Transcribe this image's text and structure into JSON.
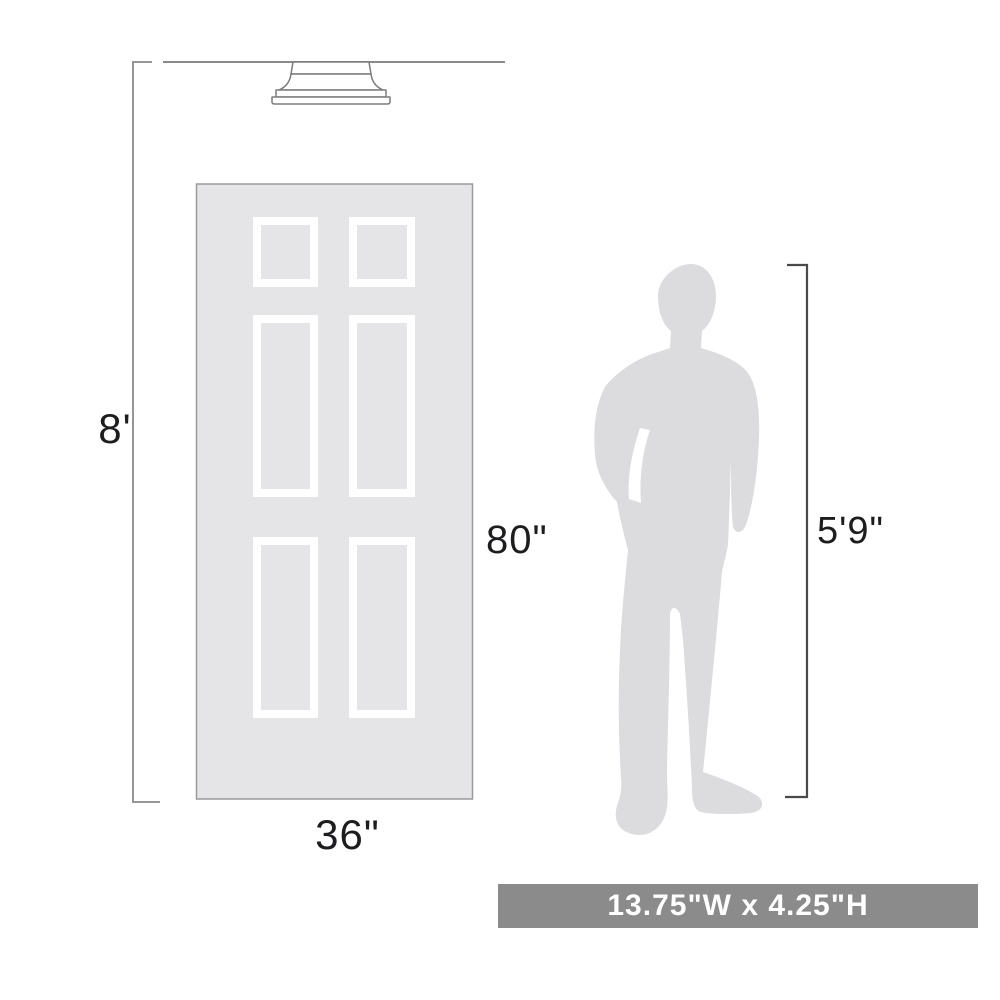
{
  "diagram": {
    "wall_height_label": "8'",
    "door_height_label": "80\"",
    "door_width_label": "36\"",
    "person_height_label": "5'9\"",
    "banner_text": "13.75\"W x 4.25\"H"
  },
  "objects": {
    "light_fixture": "flush-mount-ceiling-light",
    "door": "six-panel-door",
    "person": "standing-man-silhouette"
  },
  "colors": {
    "background": "#ffffff",
    "door_fill": "#e5e5e7",
    "door_border": "#9a9a9a",
    "panel_frame": "#ffffff",
    "person_fill": "#dcdcde",
    "dim_line_light": "#8a8a8a",
    "dim_line_dark": "#4a4a4a",
    "fixture_stroke": "#7d7d7d",
    "fixture_fill": "#ffffff",
    "label_text": "#1d1d1f",
    "banner_bg": "#8b8b8b",
    "banner_text": "#ffffff"
  }
}
